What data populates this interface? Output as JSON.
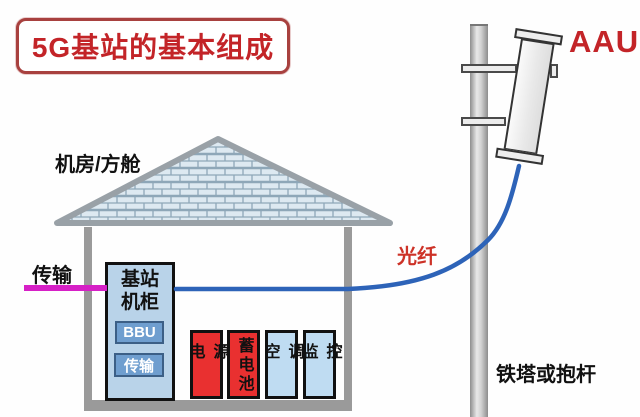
{
  "title": "5G基站的基本组成",
  "labels": {
    "room": "机房/方舱",
    "transmission": "传输",
    "fiber": "光纤",
    "aau": "AAU",
    "tower": "铁塔或抱杆"
  },
  "cabinet": {
    "name": "基站机柜",
    "modules": [
      {
        "label": "BBU"
      },
      {
        "label": "传输"
      }
    ]
  },
  "equipment": [
    {
      "label": "电源",
      "color": "#e93030"
    },
    {
      "label": "蓄电池",
      "color": "#e93030"
    },
    {
      "label": "空调",
      "color": "#bfdcf2"
    },
    {
      "label": "监控",
      "color": "#bfdcf2"
    }
  ],
  "colors": {
    "accent_red": "#c32428",
    "title_border": "#a8413f",
    "cabinet_fill": "#b9d3e9",
    "module_fill": "#6f9ecf",
    "equipment_red": "#e93030",
    "equipment_blue": "#bfdcf2",
    "fiber_blue": "#2d63b8",
    "transmission_magenta": "#d620c6",
    "structure_gray": "#9a9a9a",
    "roof_brick": "#dde9f1",
    "roof_mortar": "#8ea7b8"
  }
}
